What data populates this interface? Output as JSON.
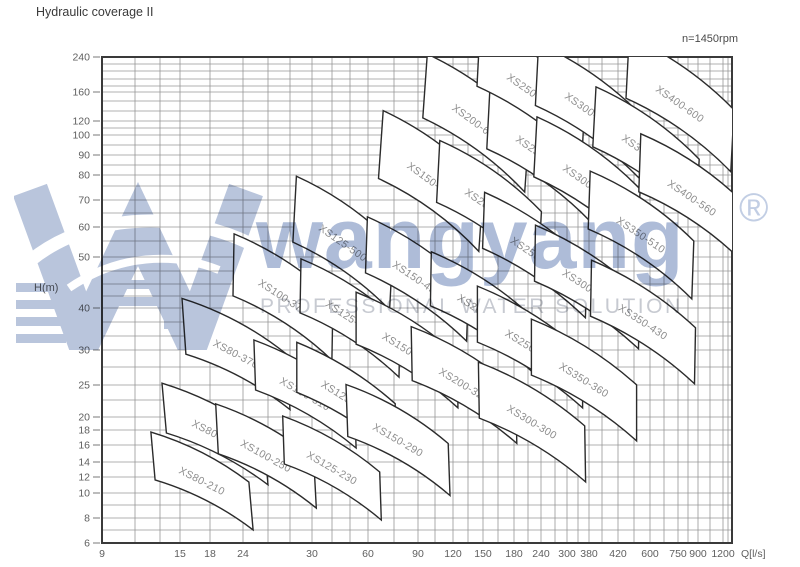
{
  "page": {
    "title": "Hydraulic coverage II",
    "speed_note": "n=1450rpm"
  },
  "watermark": {
    "brand": "wangyang",
    "registered": "®",
    "tagline": "PROFESSIONAL WATER SOLUTION",
    "brand_color": "#aab9d6",
    "logo_color": "#b9c5dc",
    "tagline_color": "#c7cad1"
  },
  "chart_data": {
    "type": "coverage-map",
    "title": "Hydraulic coverage II",
    "subtitle": "n=1450rpm",
    "xlabel": "Q[l/s]",
    "ylabel": "H(m)",
    "grid": "on",
    "x_axis_scale": "log-irregular",
    "y_axis_scale": "log-irregular",
    "xlim": [
      9,
      1200
    ],
    "ylim": [
      6,
      240
    ],
    "plot_px": {
      "left": 102,
      "right": 732,
      "top": 57,
      "bottom": 543
    },
    "x_ticks": [
      {
        "value": 9,
        "px": 102
      },
      {
        "value": 15,
        "px": 180
      },
      {
        "value": 18,
        "px": 210
      },
      {
        "value": 24,
        "px": 243
      },
      {
        "value": 30,
        "px": 312
      },
      {
        "value": 60,
        "px": 368
      },
      {
        "value": 90,
        "px": 418
      },
      {
        "value": 120,
        "px": 453
      },
      {
        "value": 150,
        "px": 483
      },
      {
        "value": 180,
        "px": 514
      },
      {
        "value": 240,
        "px": 541
      },
      {
        "value": 300,
        "px": 567
      },
      {
        "value": 380,
        "px": 589
      },
      {
        "value": 420,
        "px": 618
      },
      {
        "value": 600,
        "px": 650
      },
      {
        "value": 750,
        "px": 678
      },
      {
        "value": 900,
        "px": 698
      },
      {
        "value": 1200,
        "px": 723
      }
    ],
    "x_minor_px": [
      135,
      160,
      268,
      290,
      332,
      350,
      394,
      435,
      468,
      498,
      528,
      555,
      578,
      602,
      634,
      664,
      688,
      710,
      728
    ],
    "y_ticks": [
      {
        "value": 240,
        "px": 57
      },
      {
        "value": 160,
        "px": 92
      },
      {
        "value": 120,
        "px": 121
      },
      {
        "value": 100,
        "px": 135
      },
      {
        "value": 90,
        "px": 155
      },
      {
        "value": 80,
        "px": 175
      },
      {
        "value": 70,
        "px": 200
      },
      {
        "value": 60,
        "px": 227
      },
      {
        "value": 50,
        "px": 257
      },
      {
        "value": 40,
        "px": 308
      },
      {
        "value": 30,
        "px": 350
      },
      {
        "value": 25,
        "px": 385
      },
      {
        "value": 20,
        "px": 417
      },
      {
        "value": 18,
        "px": 430
      },
      {
        "value": 16,
        "px": 445
      },
      {
        "value": 14,
        "px": 462
      },
      {
        "value": 12,
        "px": 477
      },
      {
        "value": 10,
        "px": 493
      },
      {
        "value": 8,
        "px": 518
      },
      {
        "value": 6,
        "px": 543
      }
    ],
    "y_minor_px": [
      64,
      71,
      79,
      86,
      101,
      111,
      128,
      145,
      165,
      186,
      213,
      241,
      271,
      284,
      296,
      322,
      336,
      367,
      400,
      505,
      530
    ],
    "regions": [
      {
        "label": "XS80-210",
        "cx": 202,
        "cy": 481,
        "len": 110,
        "wid": 48,
        "angle": 27,
        "bow": 10
      },
      {
        "label": "XS80-270",
        "cx": 215,
        "cy": 434,
        "len": 114,
        "wid": 50,
        "angle": 27,
        "bow": 10
      },
      {
        "label": "XS80-370",
        "cx": 236,
        "cy": 354,
        "len": 118,
        "wid": 56,
        "angle": 28,
        "bow": 11
      },
      {
        "label": "XS100-250",
        "cx": 266,
        "cy": 456,
        "len": 112,
        "wid": 50,
        "angle": 29,
        "bow": 10
      },
      {
        "label": "XS100-310",
        "cx": 305,
        "cy": 394,
        "len": 116,
        "wid": 50,
        "angle": 30,
        "bow": 10
      },
      {
        "label": "XS100-375",
        "cx": 283,
        "cy": 297,
        "len": 118,
        "wid": 62,
        "angle": 33,
        "bow": 11
      },
      {
        "label": "XS125-230",
        "cx": 332,
        "cy": 468,
        "len": 112,
        "wid": 48,
        "angle": 30,
        "bow": 10
      },
      {
        "label": "XS125-290",
        "cx": 346,
        "cy": 398,
        "len": 116,
        "wid": 50,
        "angle": 32,
        "bow": 10
      },
      {
        "label": "XS125-365",
        "cx": 350,
        "cy": 318,
        "len": 118,
        "wid": 54,
        "angle": 33,
        "bow": 11
      },
      {
        "label": "XS125-500",
        "cx": 343,
        "cy": 243,
        "len": 118,
        "wid": 66,
        "angle": 35,
        "bow": 11
      },
      {
        "label": "XS150-290",
        "cx": 398,
        "cy": 440,
        "len": 118,
        "wid": 52,
        "angle": 30,
        "bow": 11
      },
      {
        "label": "XS150-360",
        "cx": 407,
        "cy": 350,
        "len": 120,
        "wid": 52,
        "angle": 32,
        "bow": 11
      },
      {
        "label": "XS150-450",
        "cx": 417,
        "cy": 279,
        "len": 122,
        "wid": 56,
        "angle": 34,
        "bow": 11
      },
      {
        "label": "XS150-605",
        "cx": 431,
        "cy": 181,
        "len": 124,
        "wid": 68,
        "angle": 36,
        "bow": 12
      },
      {
        "label": "XS200-320",
        "cx": 464,
        "cy": 385,
        "len": 122,
        "wid": 54,
        "angle": 31,
        "bow": 11
      },
      {
        "label": "XS200-420",
        "cx": 482,
        "cy": 312,
        "len": 122,
        "wid": 54,
        "angle": 33,
        "bow": 11
      },
      {
        "label": "XS200-520",
        "cx": 489,
        "cy": 207,
        "len": 124,
        "wid": 62,
        "angle": 35,
        "bow": 12
      },
      {
        "label": "XS200-670",
        "cx": 476,
        "cy": 123,
        "len": 126,
        "wid": 64,
        "angle": 36,
        "bow": 12
      },
      {
        "label": "XS250-370",
        "cx": 530,
        "cy": 347,
        "len": 124,
        "wid": 56,
        "angle": 32,
        "bow": 11
      },
      {
        "label": "XS250-480",
        "cx": 535,
        "cy": 255,
        "len": 124,
        "wid": 56,
        "angle": 34,
        "bow": 11
      },
      {
        "label": "XS250-600",
        "cx": 540,
        "cy": 154,
        "len": 126,
        "wid": 62,
        "angle": 35,
        "bow": 12
      },
      {
        "label": "XS250-800",
        "cx": 531,
        "cy": 92,
        "len": 128,
        "wid": 62,
        "angle": 35,
        "bow": 12
      },
      {
        "label": "XS300-300",
        "cx": 532,
        "cy": 422,
        "len": 124,
        "wid": 56,
        "angle": 31,
        "bow": 11
      },
      {
        "label": "XS300-435",
        "cx": 587,
        "cy": 287,
        "len": 124,
        "wid": 56,
        "angle": 33,
        "bow": 11
      },
      {
        "label": "XS300-560",
        "cx": 587,
        "cy": 183,
        "len": 126,
        "wid": 60,
        "angle": 35,
        "bow": 12
      },
      {
        "label": "XS300-700",
        "cx": 589,
        "cy": 111,
        "len": 127,
        "wid": 62,
        "angle": 35,
        "bow": 12
      },
      {
        "label": "XS350-360",
        "cx": 584,
        "cy": 380,
        "len": 124,
        "wid": 56,
        "angle": 32,
        "bow": 11
      },
      {
        "label": "XS350-430",
        "cx": 643,
        "cy": 322,
        "len": 124,
        "wid": 56,
        "angle": 33,
        "bow": 11
      },
      {
        "label": "XS350-510",
        "cx": 641,
        "cy": 235,
        "len": 125,
        "wid": 58,
        "angle": 34,
        "bow": 12
      },
      {
        "label": "XS350-630",
        "cx": 646,
        "cy": 153,
        "len": 126,
        "wid": 60,
        "angle": 35,
        "bow": 12
      },
      {
        "label": "XS400-560",
        "cx": 692,
        "cy": 198,
        "len": 126,
        "wid": 58,
        "angle": 34,
        "bow": 12
      },
      {
        "label": "XS400-600",
        "cx": 680,
        "cy": 104,
        "len": 128,
        "wid": 62,
        "angle": 35,
        "bow": 12
      }
    ],
    "style": {
      "grid_color": "#969696",
      "border_color": "#3a3a3a",
      "region_fill": "#ffffff",
      "region_stroke": "#2b2b2b",
      "region_label_color": "#8d8d8d",
      "axis_label_color": "#5f5f5f"
    }
  }
}
